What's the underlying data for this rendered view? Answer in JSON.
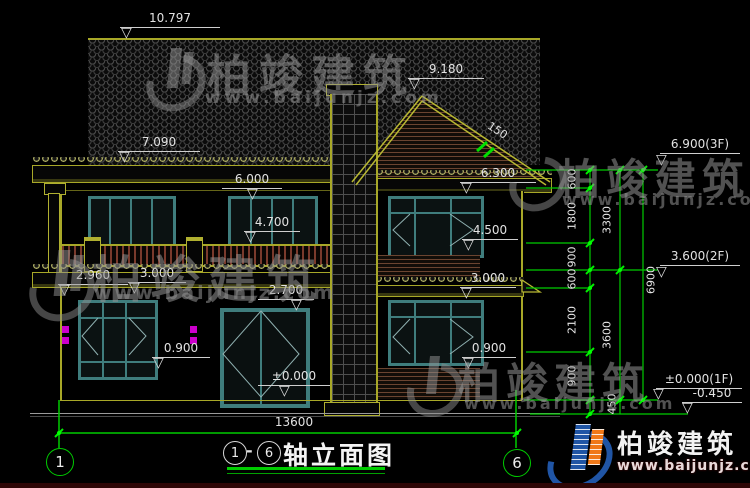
{
  "watermark": {
    "brand": "柏竣建筑",
    "url": "www.baijunjz.com"
  },
  "logo": {
    "brand": "柏竣建筑",
    "url": "www.baijunjz.com"
  },
  "glyphs": {
    "level_marker": "▽",
    "dash": "-"
  },
  "footer": {
    "axis_left": "1",
    "axis_right": "6",
    "title_axis_start": "1",
    "title_axis_end": "6",
    "title_text": "轴立面图",
    "total_width_dim": "13600"
  },
  "elevation_labels": {
    "ridge": "10.797",
    "left_eave": "7.090",
    "gable_ridge": "9.180",
    "right_eave": "6.300",
    "balcony_window_top": "6.000",
    "balcony_rail_top": "4.700",
    "right_2f_sill": "4.500",
    "porch_eave_left": "2.960",
    "porch_eave": "3.000",
    "right_mid_eave": "3.000",
    "door_top": "2.700",
    "left_1f_sill": "0.900",
    "right_1f_sill": "0.900",
    "ground": "±0.000",
    "roof_slope": "150"
  },
  "right_panel": {
    "level_3f": "6.900(3F)",
    "level_2f": "3.600(2F)",
    "level_1f": "±0.000(1F)",
    "level_site": "-0.450",
    "chain_inner": [
      "600",
      "1800",
      "900",
      "600",
      "2100",
      "900",
      "450"
    ],
    "chain_mid": [
      "3300",
      "3600"
    ],
    "chain_outer": [
      "6900"
    ]
  },
  "colors": {
    "dim_line_green": "#00cc00",
    "outline_olive": "#b8b832",
    "window_teal": "#3f7d7d",
    "lamp_magenta": "#cc00cc",
    "logo_blue": "#2055a5",
    "logo_orange": "#f07818"
  }
}
